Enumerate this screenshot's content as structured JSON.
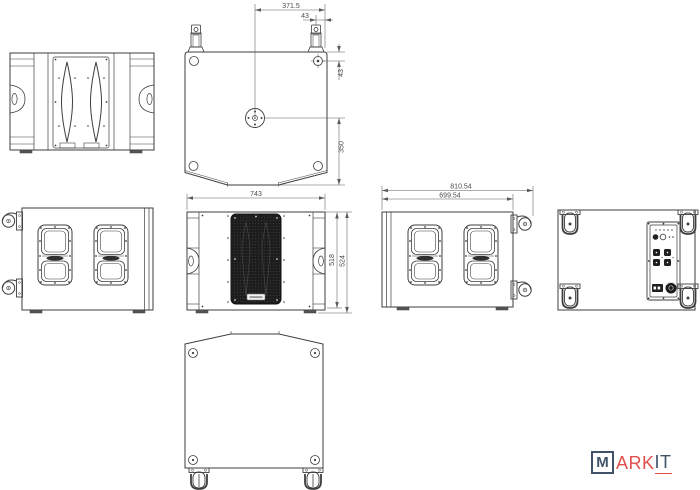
{
  "drawing": {
    "dimensions": {
      "top_view": {
        "half_width": "371.5",
        "bracket_offset": "43",
        "corner_offset": "43",
        "pole_to_front": "350"
      },
      "front_view": {
        "width": "743",
        "height_cabinet": "518",
        "height_overall": "524"
      },
      "side_view": {
        "depth_overall": "810.54",
        "depth_cabinet": "699.54"
      }
    },
    "colors": {
      "line": "#3e3e3e",
      "dim_line": "#5a5a5a",
      "dim_text": "#4a4a4a",
      "grille_fill": "#1d1d1d",
      "background": "#ffffff",
      "logo_navy": "#41526b",
      "logo_red": "#e04f4b"
    },
    "logo": {
      "m": "M",
      "ark": "ARK",
      "it": "IT"
    }
  }
}
